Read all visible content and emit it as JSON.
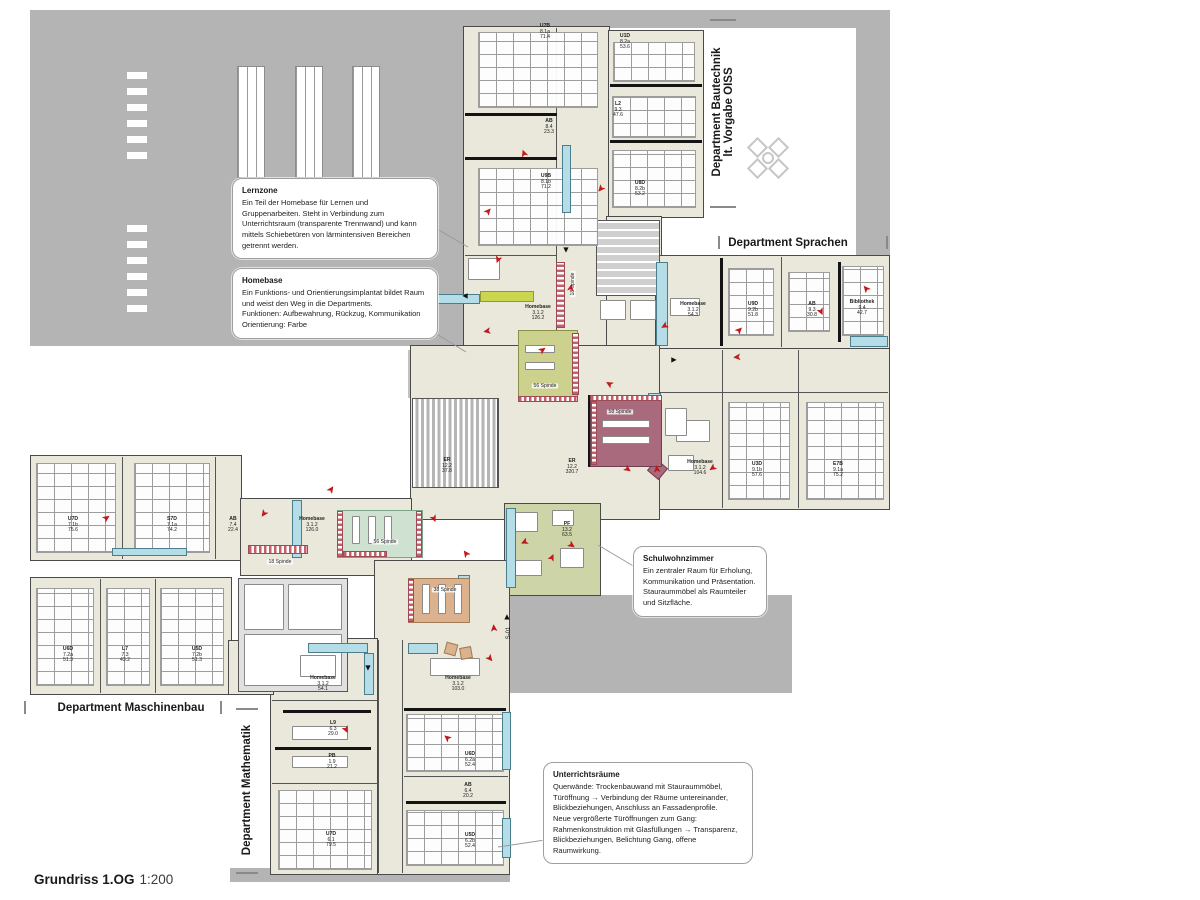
{
  "title": {
    "main": "Grundriss 1.OG",
    "scale": "1:200"
  },
  "landmarks": {
    "s01": "S-01"
  },
  "departments": [
    {
      "label": "Department Bautechnik\nlt. Vorgabe OISS"
    },
    {
      "label": "Department Sprachen"
    },
    {
      "label": "Department Maschinenbau"
    },
    {
      "label": "Department Mathematik"
    }
  ],
  "callouts": {
    "lernzone": {
      "title": "Lernzone",
      "body": "Ein Teil der Homebase für Lernen und Gruppenarbeiten. Steht in Verbindung zum Unterrichtsraum (transparente Trennwand) und kann mittels Schiebetüren von lärmintensiven Bereichen getrennt werden."
    },
    "homebase": {
      "title": "Homebase",
      "body": "Ein Funktions- und Orientierungsimplantat bildet Raum und weist den Weg in die Departments.\nFunktionen: Aufbewahrung, Rückzug, Kommunikation\nOrientierung: Farbe"
    },
    "schulwohnzimmer": {
      "title": "Schulwohnzimmer",
      "body": "Ein zentraler Raum für Erholung, Kommunikation und Präsentation. Stauraummöbel als Raumteiler und Sitzfläche."
    },
    "unterrichtsraeume": {
      "title": "Unterrichtsräume",
      "body": "Querwände: Trockenbauwand mit Stauraummöbel, Türöffnung → Verbindung der Räume untereinander, Blickbeziehungen, Anschluss an Fassadenprofile.\nNeue vergrößerte Türöffnungen zum Gang: Rahmenkonstruktion mit Glasfüllungen → Transparenz, Blickbeziehungen, Belichtung Gang, offene Raumwirkung."
    }
  },
  "rooms": [
    {
      "lines": [
        "U7B",
        "8.1a",
        "71.4"
      ],
      "x": 545,
      "y": 32
    },
    {
      "lines": [
        "U1D",
        "8.2a",
        "53.6"
      ],
      "x": 625,
      "y": 42
    },
    {
      "lines": [
        "AB",
        "8.4",
        "23.3"
      ],
      "x": 549,
      "y": 127
    },
    {
      "lines": [
        "L2",
        "9.3",
        "47.6"
      ],
      "x": 618,
      "y": 110
    },
    {
      "lines": [
        "U9B",
        "8.1b",
        "71.2"
      ],
      "x": 546,
      "y": 182
    },
    {
      "lines": [
        "U8D",
        "8.2b",
        "53.2"
      ],
      "x": 640,
      "y": 189
    },
    {
      "lines": [
        "Homebase",
        "3.1.2",
        "126.2"
      ],
      "x": 538,
      "y": 313
    },
    {
      "lines": [
        "Homebase",
        "3.1.2",
        "54.3"
      ],
      "x": 693,
      "y": 310
    },
    {
      "lines": [
        "U9D",
        "9.2b",
        "51.8"
      ],
      "x": 753,
      "y": 310
    },
    {
      "lines": [
        "AB",
        "9.3",
        "30.8"
      ],
      "x": 812,
      "y": 310
    },
    {
      "lines": [
        "Bibliothek",
        "9.4",
        "42.7"
      ],
      "x": 862,
      "y": 308
    },
    {
      "lines": [
        "ER",
        "12.2",
        "37.8"
      ],
      "x": 447,
      "y": 466
    },
    {
      "lines": [
        "ER",
        "12.2",
        "320.7"
      ],
      "x": 572,
      "y": 467
    },
    {
      "lines": [
        "Homebase",
        "3.1.2",
        "104.6"
      ],
      "x": 700,
      "y": 468
    },
    {
      "lines": [
        "U3D",
        "9.1b",
        "57.6"
      ],
      "x": 757,
      "y": 470
    },
    {
      "lines": [
        "E7B",
        "9.1a",
        "75.2"
      ],
      "x": 838,
      "y": 470
    },
    {
      "lines": [
        "PF",
        "13.2",
        "63.5"
      ],
      "x": 567,
      "y": 530
    },
    {
      "lines": [
        "U7D",
        "7.1b",
        "75.6"
      ],
      "x": 73,
      "y": 525
    },
    {
      "lines": [
        "S7D",
        "7.1a",
        "74.2"
      ],
      "x": 172,
      "y": 525
    },
    {
      "lines": [
        "AB",
        "7.4",
        "22.4"
      ],
      "x": 233,
      "y": 525
    },
    {
      "lines": [
        "Homebase",
        "3.1.2",
        "126.0"
      ],
      "x": 312,
      "y": 525
    },
    {
      "lines": [
        "U6D",
        "7.2a",
        "51.3"
      ],
      "x": 68,
      "y": 655
    },
    {
      "lines": [
        "L7",
        "7.3",
        "43.2"
      ],
      "x": 125,
      "y": 655
    },
    {
      "lines": [
        "U5D",
        "7.2b",
        "51.3"
      ],
      "x": 197,
      "y": 655
    },
    {
      "lines": [
        "Homebase",
        "3.1.2",
        "54.1"
      ],
      "x": 323,
      "y": 684
    },
    {
      "lines": [
        "Homebase",
        "3.1.2",
        "103.0"
      ],
      "x": 458,
      "y": 684
    },
    {
      "lines": [
        "L9",
        "6.3",
        "29.0"
      ],
      "x": 333,
      "y": 729
    },
    {
      "lines": [
        "PB",
        "1.9",
        "21.2"
      ],
      "x": 332,
      "y": 762
    },
    {
      "lines": [
        "U7D",
        "6.1",
        "79.5"
      ],
      "x": 331,
      "y": 840
    },
    {
      "lines": [
        "U6D",
        "6.2a",
        "52.4"
      ],
      "x": 470,
      "y": 760
    },
    {
      "lines": [
        "AB",
        "6.4",
        "20.2"
      ],
      "x": 468,
      "y": 791
    },
    {
      "lines": [
        "U5D",
        "6.2b",
        "52.4"
      ],
      "x": 470,
      "y": 841
    }
  ],
  "spinde": [
    {
      "t": "56 Spinde",
      "x": 545,
      "y": 386,
      "r": 0
    },
    {
      "t": "58 Spinde",
      "x": 620,
      "y": 412,
      "r": 0
    },
    {
      "t": "56 Spinde",
      "x": 385,
      "y": 542,
      "r": 0
    },
    {
      "t": "18 Spinde",
      "x": 280,
      "y": 562,
      "r": 0
    },
    {
      "t": "38 Spinde",
      "x": 445,
      "y": 590,
      "r": 0
    },
    {
      "t": "18 Spinde",
      "x": 573,
      "y": 284,
      "r": -90
    }
  ],
  "arrows": [
    {
      "x": 489,
      "y": 212,
      "r": -50
    },
    {
      "x": 497,
      "y": 259,
      "r": 110
    },
    {
      "x": 487,
      "y": 330,
      "r": 170
    },
    {
      "x": 543,
      "y": 351,
      "r": -35
    },
    {
      "x": 610,
      "y": 383,
      "r": -150
    },
    {
      "x": 572,
      "y": 288,
      "r": -80
    },
    {
      "x": 600,
      "y": 188,
      "r": 130
    },
    {
      "x": 525,
      "y": 153,
      "r": -110
    },
    {
      "x": 664,
      "y": 325,
      "r": 150
    },
    {
      "x": 740,
      "y": 331,
      "r": -45
    },
    {
      "x": 737,
      "y": 356,
      "r": 175
    },
    {
      "x": 820,
      "y": 312,
      "r": 65
    },
    {
      "x": 867,
      "y": 288,
      "r": -130
    },
    {
      "x": 658,
      "y": 469,
      "r": -95
    },
    {
      "x": 712,
      "y": 467,
      "r": 145
    },
    {
      "x": 627,
      "y": 470,
      "r": 35
    },
    {
      "x": 332,
      "y": 490,
      "r": -55
    },
    {
      "x": 263,
      "y": 513,
      "r": 125
    },
    {
      "x": 107,
      "y": 519,
      "r": -35
    },
    {
      "x": 433,
      "y": 519,
      "r": 65
    },
    {
      "x": 467,
      "y": 553,
      "r": -125
    },
    {
      "x": 524,
      "y": 541,
      "r": 155
    },
    {
      "x": 553,
      "y": 558,
      "r": -65
    },
    {
      "x": 571,
      "y": 546,
      "r": 35
    },
    {
      "x": 495,
      "y": 628,
      "r": -95
    },
    {
      "x": 489,
      "y": 659,
      "r": 50
    },
    {
      "x": 448,
      "y": 737,
      "r": -140
    },
    {
      "x": 345,
      "y": 730,
      "r": 65
    }
  ],
  "nav_arrows": [
    {
      "g": "◄",
      "x": 465,
      "y": 296
    },
    {
      "g": "►",
      "x": 674,
      "y": 360
    },
    {
      "g": "▼",
      "x": 566,
      "y": 250
    },
    {
      "g": "▼",
      "x": 368,
      "y": 668
    },
    {
      "g": "▲",
      "x": 507,
      "y": 617
    }
  ],
  "colors": {
    "background_panels": "#b4b4b4",
    "floor": "#eae8db",
    "wall": "#4a4a4a",
    "locker_cyan": "#b5dde8",
    "spinde_olive": "#ccd28d",
    "spinde_mauve": "#a96a7d",
    "spinde_mint": "#cfe2d2",
    "spinde_tan": "#dcb28e",
    "wohnzimmer_green": "#cdd5a8",
    "accent_red": "#c1181c",
    "checker_red": "#c4606a"
  }
}
